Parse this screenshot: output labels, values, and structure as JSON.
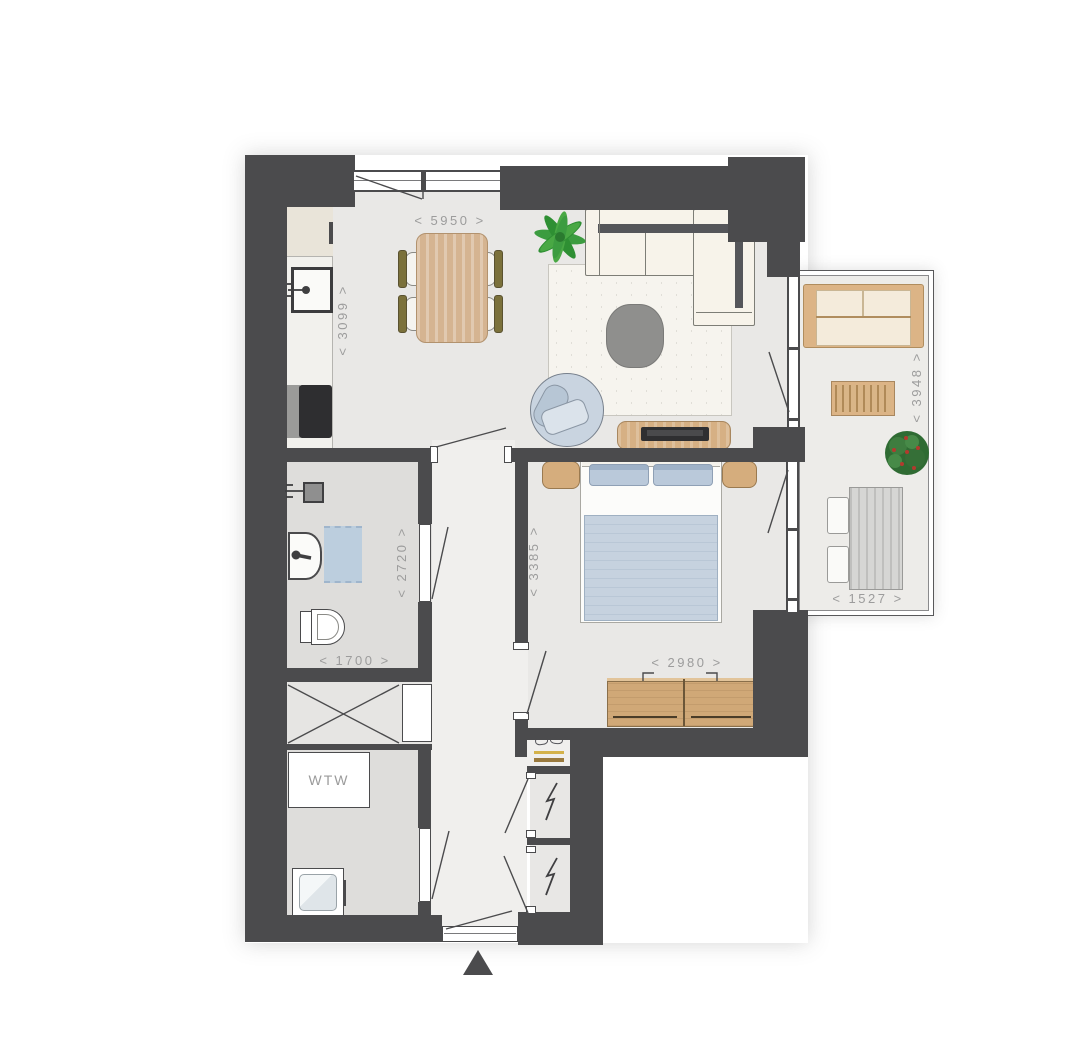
{
  "floorplan": {
    "dimensions": {
      "living_width": "< 5950 >",
      "kitchen_depth": "< 3099 >",
      "bathroom_depth": "< 2720 >",
      "bathroom_width": "< 1700 >",
      "bedroom_depth": "< 3385 >",
      "bedroom_width": "< 2980 >",
      "balcony_depth": "< 3948 >",
      "balcony_width": "< 1527 >"
    },
    "labels": {
      "ventilation_unit": "WTW"
    },
    "colors": {
      "wall": "#4b4b4d",
      "floor": "#e9e8e6",
      "floor_bathroom": "#dedddb",
      "floor_hall": "#f0efed",
      "floor_balcony": "#edece9",
      "wood": "#d3ac7d",
      "upholstery_blue": "#c4d0dd",
      "sofa_cream": "#f7f3ea",
      "plant_green": "#3c9c40",
      "dimension_text": "#9c9c9c"
    }
  }
}
